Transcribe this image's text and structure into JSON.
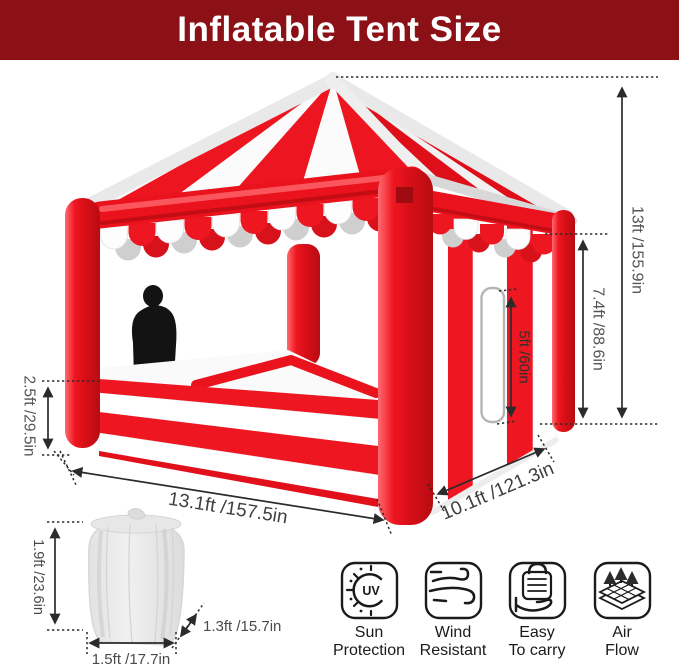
{
  "header": {
    "title": "Inflatable Tent Size"
  },
  "dimensions": {
    "total_height": "13ft /155.9in",
    "side_wall_height": "7.4ft /88.6in",
    "door_height": "5ft /60in",
    "counter_height": "2.5ft /29.5in",
    "width": "13.1ft /157.5in",
    "depth": "10.1ft /121.3in"
  },
  "bag": {
    "height": "1.9ft /23.6in",
    "bottom_width": "1.5ft /17.7in",
    "diameter": "1.3ft /15.7in"
  },
  "features": [
    {
      "icon": "uv-sun-icon",
      "icon_text": "UV",
      "line1": "Sun",
      "line2": "Protection"
    },
    {
      "icon": "wind-icon",
      "line1": "Wind",
      "line2": "Resistant"
    },
    {
      "icon": "carry-bag-icon",
      "line1": "Easy",
      "line2": "To carry"
    },
    {
      "icon": "air-flow-icon",
      "line1": "Air",
      "line2": "Flow"
    }
  ],
  "colors": {
    "header_bg": "#8c1116",
    "tent_red": "#ea121c",
    "tent_dark_red": "#b70c12",
    "stripe_white": "#ffffff",
    "scallop_gray": "#cfcfcf",
    "trim_gray": "#d8d8d8",
    "annotation": "#2b2b2b",
    "silhouette": "#131313"
  }
}
